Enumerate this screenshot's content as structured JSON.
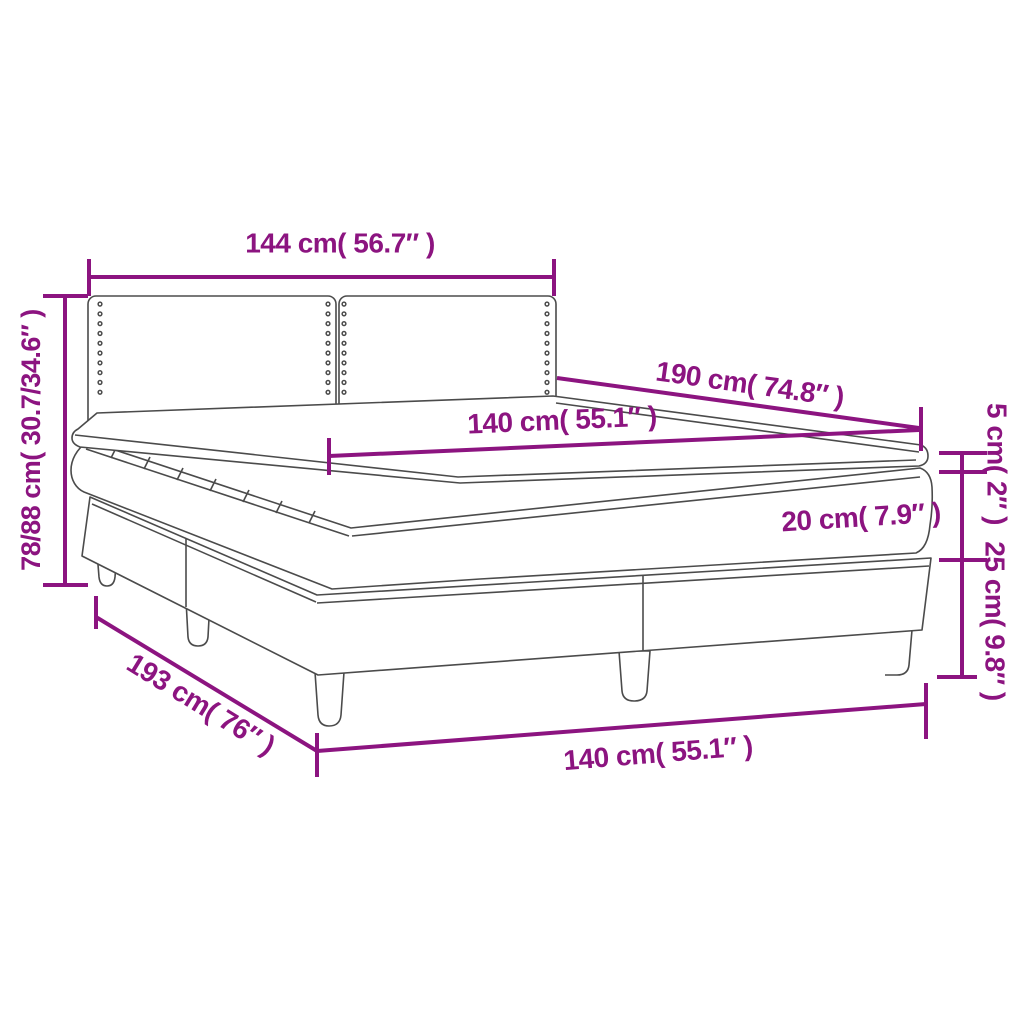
{
  "diagram": {
    "title": "Box spring bed dimension diagram",
    "colors": {
      "dimension_color": "#8C1480",
      "outline_color": "#4B4B4B",
      "background": "#FFFFFF"
    },
    "dimensions": {
      "headboard_width": "144 cm( 56.7″ )",
      "overall_height": "78/88 cm( 30.7/34.6″ )",
      "length_top": "190 cm( 74.8″ )",
      "width_top": "140 cm( 55.1″ )",
      "topper_height": "5 cm( 2″ )",
      "mattress_height": "20 cm( 7.9″ )",
      "base_height": "25 cm( 9.8″ )",
      "base_length": "193 cm( 76″ )",
      "base_width": "140 cm( 55.1″ )"
    }
  }
}
